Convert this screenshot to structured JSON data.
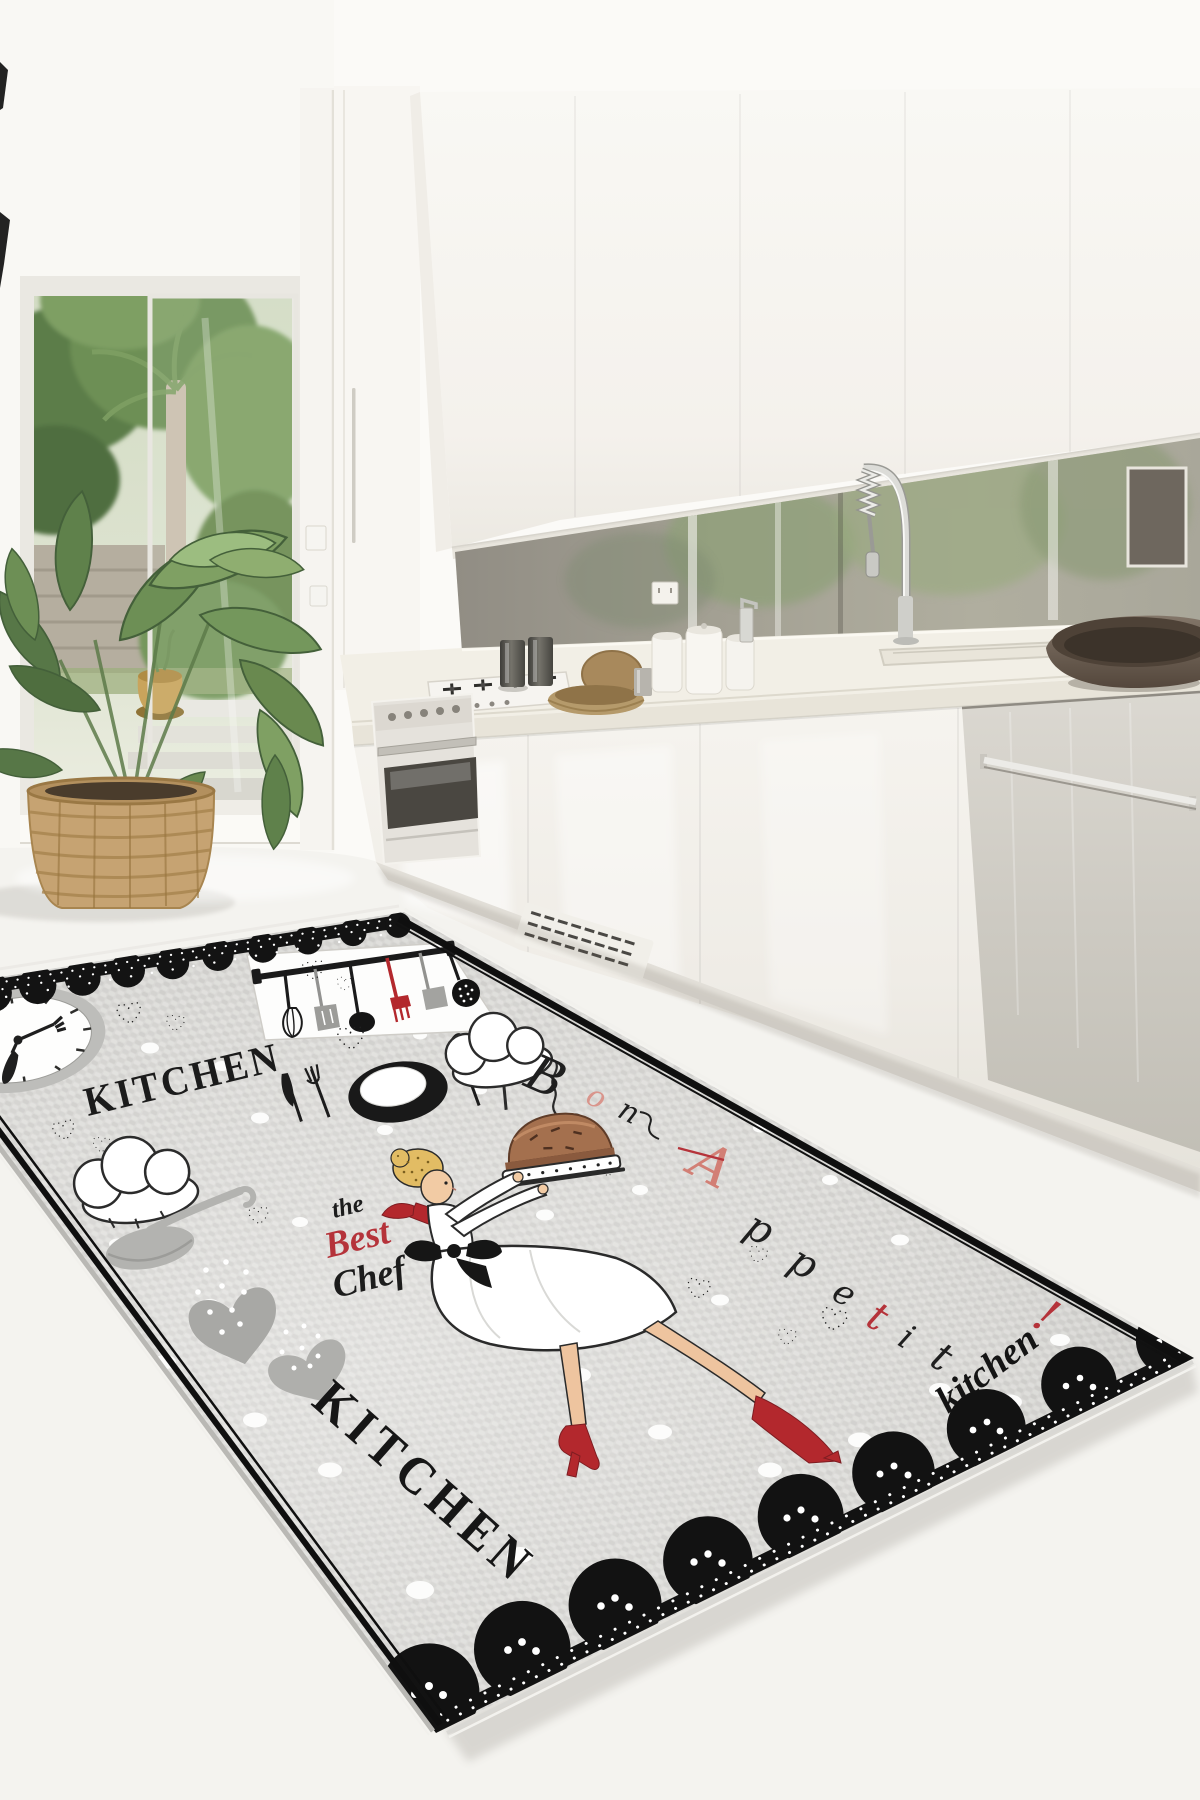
{
  "image": {
    "type": "product-photo",
    "subject": "Chef-themed gray decorative kitchen rug lying in a modern white kitchen",
    "setting": "white gloss kitchen with mirror backsplash, open patio door to a garden, potted plant, gas cooktop, oven, sink and dishwasher"
  },
  "palette": {
    "rug_base": "#d7d6d3",
    "lace_black": "#141414",
    "accent_red": "#b3282d",
    "script_red": "#b5333a",
    "accent_pink": "#d9958c",
    "skin": "#f2cba4",
    "hair_blonde": "#e2bc64",
    "pie_brown": "#a4704e",
    "counter_cream": "#f2efe6",
    "leaf_green": "#74975c",
    "basket_tan": "#c6a372",
    "steel_gray": "#cfccc6"
  },
  "rug": {
    "title_top": "KITCHEN",
    "title_side": "KITCHEN",
    "script": {
      "line1": "the",
      "line2": "Best",
      "line3": "Chef"
    },
    "corner_script": "kitchen",
    "vertical_word": "Bon Appetit!",
    "vertical_letters": [
      {
        "ch": "B",
        "color": "#1f1f1f"
      },
      {
        "ch": "o",
        "color": "#d9958c"
      },
      {
        "ch": "n",
        "color": "#1f1f1f"
      },
      {
        "ch": "A",
        "color": "#d27f75"
      },
      {
        "ch": "p",
        "color": "#1f1f1f"
      },
      {
        "ch": "p",
        "color": "#1f1f1f"
      },
      {
        "ch": "e",
        "color": "#1f1f1f"
      },
      {
        "ch": "t",
        "color": "#b5333a"
      },
      {
        "ch": "i",
        "color": "#1f1f1f"
      },
      {
        "ch": "t",
        "color": "#1f1f1f"
      },
      {
        "ch": "!",
        "color": "#b5333a"
      }
    ],
    "motifs": [
      "wall clock with fork and knife hands",
      "hanging utensil rack",
      "chef hats",
      "plate with cutlery",
      "gray ladle",
      "polka-dot hearts",
      "dotted hearts",
      "chef girl holding a pie",
      "scattered white dots",
      "black lace scalloped borders"
    ]
  }
}
